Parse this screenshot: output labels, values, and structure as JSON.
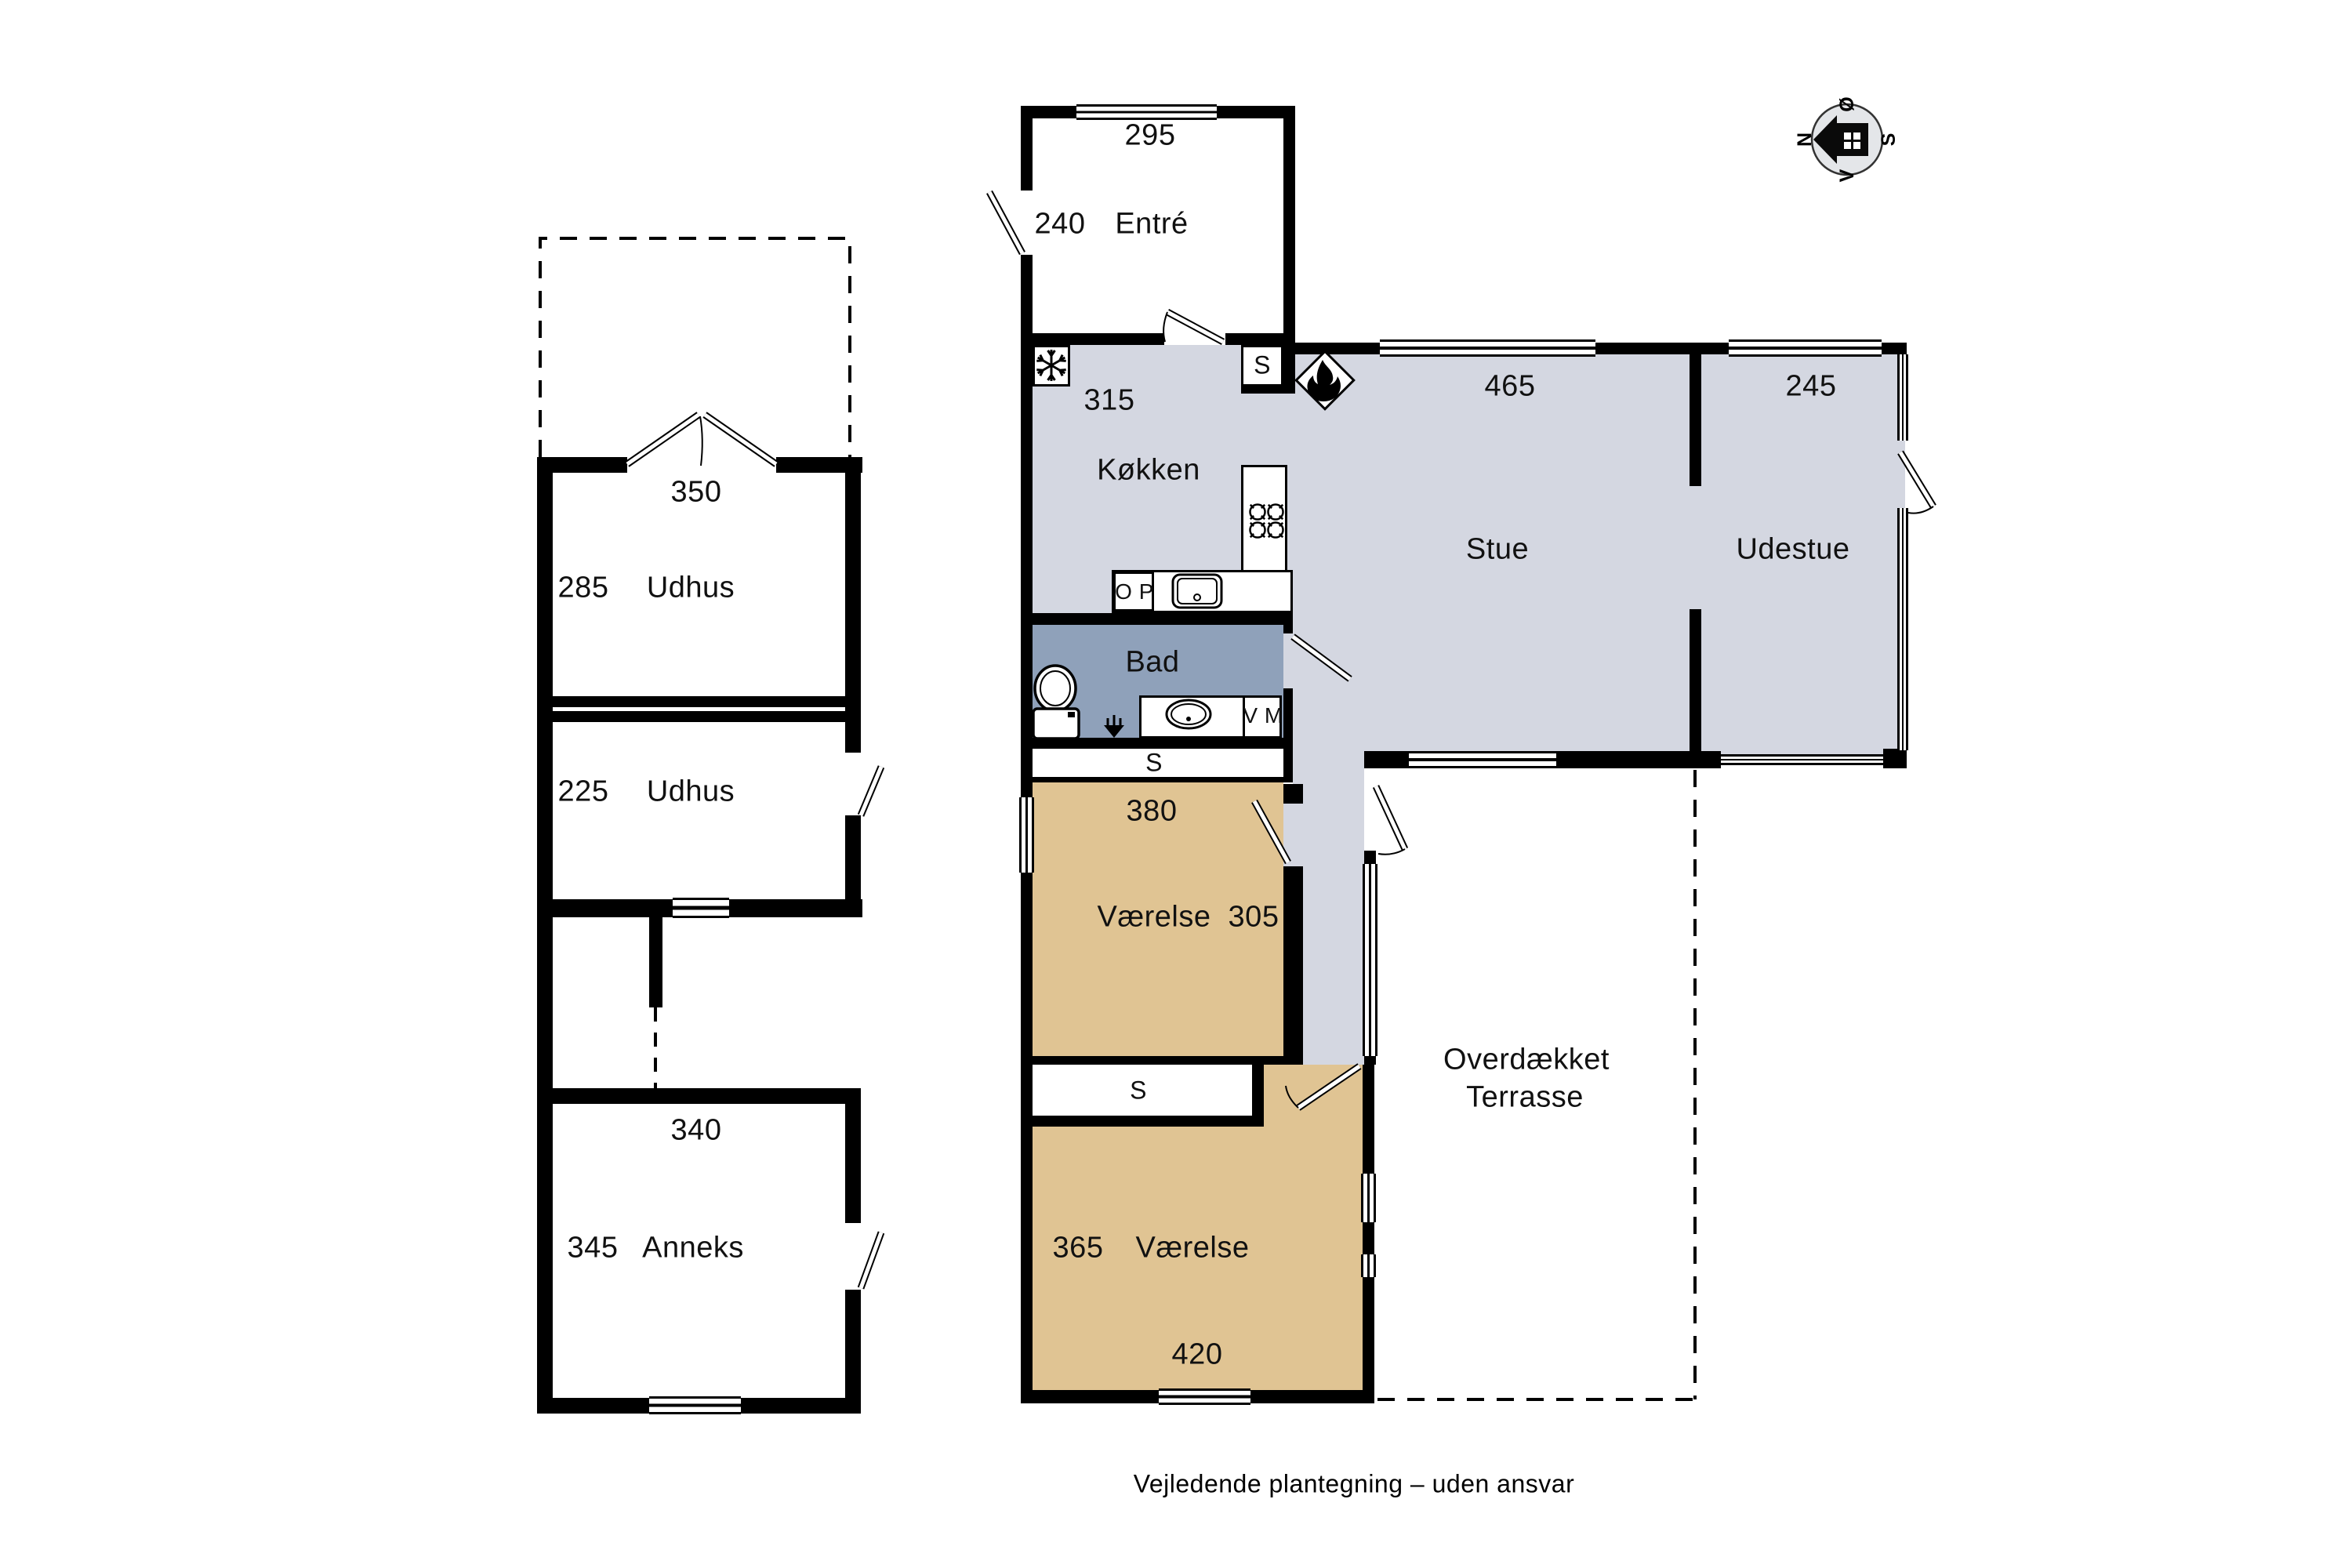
{
  "caption": "Vejledende plantegning – uden ansvar",
  "compass": {
    "north": "N",
    "east": "Ø",
    "south": "S",
    "west": "V"
  },
  "colors": {
    "floor_gray": "#d4d7e1",
    "floor_tan": "#e0c493",
    "floor_blue": "#8fa1ba",
    "wall": "#000000",
    "compass_fill": "#e4e6e9"
  },
  "main_house": {
    "entre": {
      "name": "Entré",
      "width": "295",
      "depth": "240"
    },
    "koekken": {
      "name": "Køkken",
      "width": "315"
    },
    "stue": {
      "name": "Stue",
      "width": "465"
    },
    "udestue": {
      "name": "Udestue",
      "width": "245"
    },
    "bad": {
      "name": "Bad"
    },
    "vaerelse_1": {
      "name": "Værelse",
      "width": "380",
      "depth": "305"
    },
    "vaerelse_2": {
      "name": "Værelse",
      "depth": "365",
      "width": "420"
    },
    "closet_kitchen": "S",
    "closet_1": "S",
    "closet_2": "S",
    "oven": "O P",
    "washing_machine": "V M"
  },
  "outbuildings": {
    "udhus_1": {
      "name": "Udhus",
      "width": "350",
      "depth": "285"
    },
    "udhus_2": {
      "name": "Udhus",
      "depth": "225"
    },
    "anneks": {
      "name": "Anneks",
      "width": "340",
      "depth": "345"
    },
    "terrasse": {
      "line1": "Overdækket",
      "line2": "Terrasse"
    }
  }
}
